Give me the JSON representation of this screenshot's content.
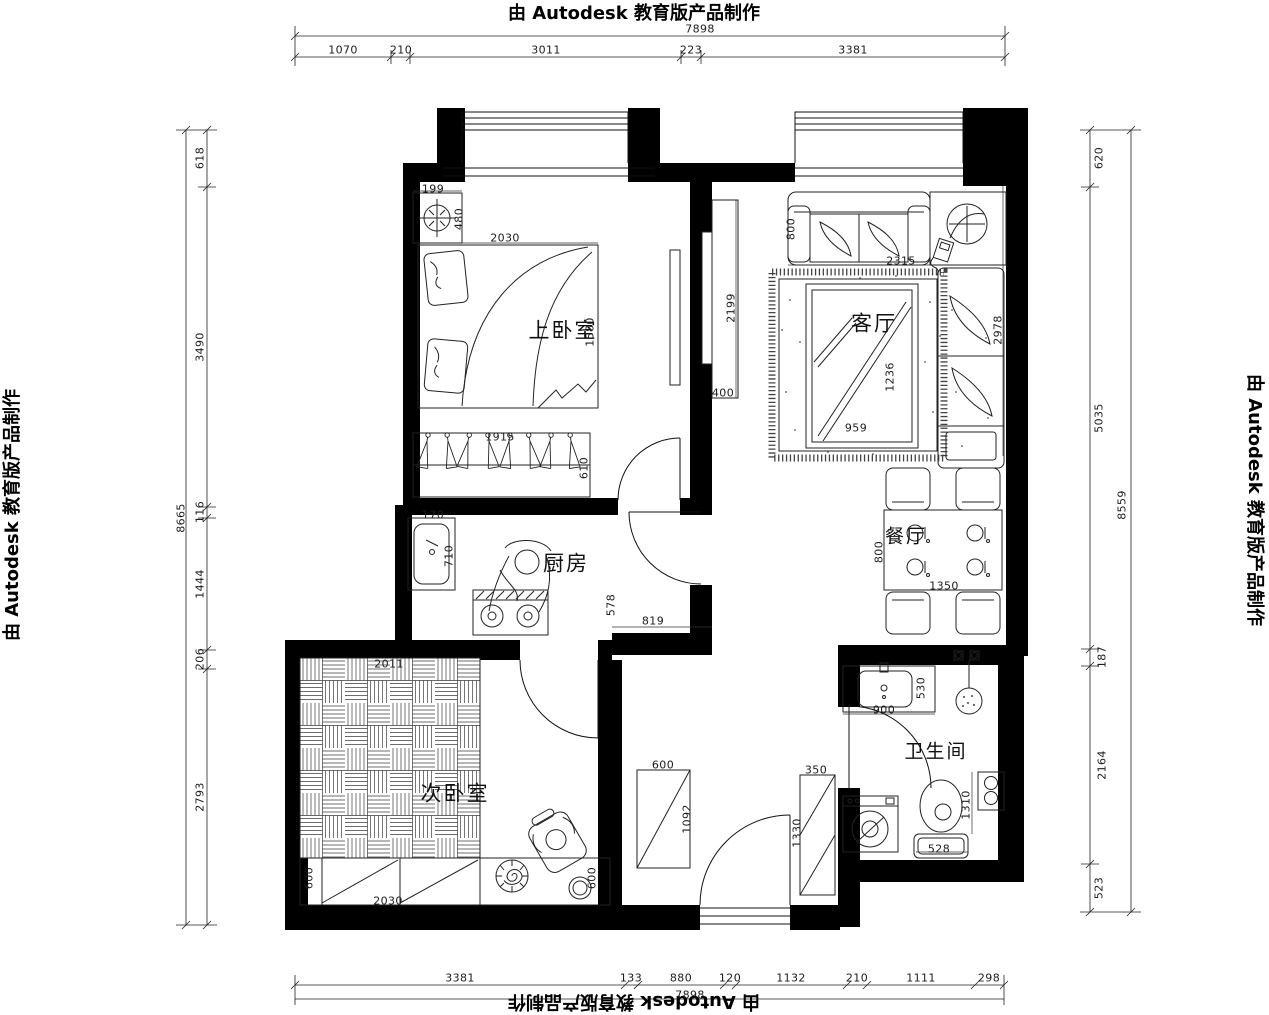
{
  "watermark": {
    "text": "由 Autodesk 教育版产品制作"
  },
  "rooms": {
    "master_bedroom": "上卧室",
    "living_room": "客厅",
    "kitchen": "厨房",
    "dining": "餐厅",
    "second_bedroom": "次卧室",
    "bathroom": "卫生间"
  },
  "dim_chains": {
    "top": {
      "total": "7898",
      "segments": [
        "1070",
        "210",
        "3011",
        "223",
        "3381"
      ]
    },
    "bottom": {
      "total": "7898",
      "segments": [
        "3381",
        "133",
        "880",
        "120",
        "1132",
        "210",
        "1111",
        "298"
      ]
    },
    "left": {
      "total": "8665",
      "segments": [
        "618",
        "3490",
        "116",
        "1444",
        "206",
        "2793"
      ]
    },
    "right": {
      "total": "8559",
      "segments": [
        "620",
        "5035",
        "187",
        "2164",
        "523"
      ]
    }
  },
  "dims": {
    "corner_cabinet_w": "199",
    "corner_cabinet_h": "480",
    "bed_w": "2030",
    "bed_len": "1580",
    "wardrobe_w": "1915",
    "wardrobe_d": "610",
    "sink_w": "170",
    "sink_len": "710",
    "kitchen_counter_d": "578",
    "kitchen_counter_w": "819",
    "tv_wall_len": "2199",
    "tv_wall_d": "400",
    "sofa_d": "800",
    "sofa_w": "2315",
    "coffee_table_len": "1236",
    "coffee_table_w": "959",
    "chaise_len": "2978",
    "dining_table_d": "800",
    "dining_table_w": "1350",
    "vanity_w": "900",
    "vanity_d": "530",
    "toilet_clearance": "1310",
    "toilet_w": "528",
    "tatami_w": "2011",
    "low_cabinet_d": "600",
    "low_cabinet_w": "2030",
    "stool_d": "600",
    "hall_cabinet_w": "600",
    "hall_cabinet_len": "1092",
    "shoe_cabinet_d": "350",
    "shoe_cabinet_len": "1330"
  }
}
